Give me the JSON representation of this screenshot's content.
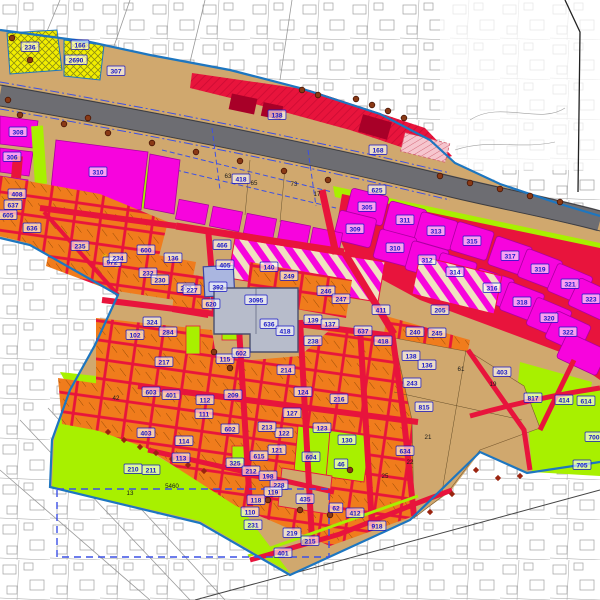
{
  "map": {
    "type": "zoning-development-plan",
    "background": "cadastral-linework"
  },
  "palette": {
    "white": "#ffffff",
    "cadastral": "#8f8f8f",
    "tan": "#d0a86e",
    "tanEdge": "#9a7640",
    "highway": "#6d6d72",
    "highwayEdge": "#3c3c40",
    "red": "#e8143c",
    "redDark": "#a80028",
    "magenta": "#f704dd",
    "magentaEdge": "#aa00a0",
    "orange": "#f07c1c",
    "chartreuse": "#a8f000",
    "chartreuseEdge": "#5a9000",
    "yellow": "#f2ee00",
    "yellowHatch": "#8e8e12",
    "cream": "#f0e2c0",
    "blueBoundary": "#1d76c0",
    "blueDashed": "#3c50e6",
    "labelBlue": "#1616c8",
    "labelBoxBg": "#ffffff",
    "black": "#1a1a1a",
    "buildingGray": "#b7bccb",
    "buildingGrayEdge": "#4a4f6e",
    "buildingBlue": "#aab6e0",
    "tree": "#8a3a16",
    "treeEdge": "#4a1505",
    "shrub": "#9b2410",
    "pinkHatchBg": "#f6c6ce",
    "pinkHatchLine": "#d06070",
    "star": "#e8d800"
  },
  "labels": {
    "blue": [
      [
        "166",
        80,
        45
      ],
      [
        "236",
        30,
        47
      ],
      [
        "2690",
        76,
        60
      ],
      [
        "307",
        116,
        71
      ],
      [
        "138",
        277,
        115
      ],
      [
        "168",
        378,
        150
      ],
      [
        "418",
        241,
        179
      ],
      [
        "625",
        377,
        190
      ],
      [
        "308",
        18,
        132
      ],
      [
        "306",
        12,
        157
      ],
      [
        "310",
        98,
        172
      ],
      [
        "408",
        17,
        194
      ],
      [
        "637",
        13,
        205
      ],
      [
        "605",
        8,
        215
      ],
      [
        "636",
        32,
        228
      ],
      [
        "972",
        112,
        262
      ],
      [
        "235",
        80,
        246
      ],
      [
        "600",
        146,
        250
      ],
      [
        "234",
        118,
        258
      ],
      [
        "136",
        173,
        258
      ],
      [
        "232",
        148,
        273
      ],
      [
        "230",
        160,
        280
      ],
      [
        "207",
        186,
        288
      ],
      [
        "466",
        222,
        245
      ],
      [
        "405",
        225,
        265
      ],
      [
        "140",
        269,
        267
      ],
      [
        "249",
        289,
        276
      ],
      [
        "246",
        326,
        291
      ],
      [
        "247",
        341,
        299
      ],
      [
        "227",
        192,
        290
      ],
      [
        "392",
        218,
        287
      ],
      [
        "620",
        211,
        304
      ],
      [
        "3095",
        256,
        300
      ],
      [
        "636",
        269,
        324
      ],
      [
        "418",
        285,
        331
      ],
      [
        "102",
        135,
        335
      ],
      [
        "324",
        152,
        322
      ],
      [
        "284",
        168,
        332
      ],
      [
        "217",
        164,
        362
      ],
      [
        "115",
        225,
        359
      ],
      [
        "602",
        241,
        353
      ],
      [
        "139",
        313,
        320
      ],
      [
        "137",
        330,
        324
      ],
      [
        "238",
        313,
        341
      ],
      [
        "214",
        286,
        370
      ],
      [
        "411",
        381,
        310
      ],
      [
        "637",
        363,
        331
      ],
      [
        "418",
        383,
        341
      ],
      [
        "305",
        367,
        207
      ],
      [
        "311",
        405,
        220
      ],
      [
        "313",
        436,
        231
      ],
      [
        "315",
        472,
        241
      ],
      [
        "317",
        510,
        256
      ],
      [
        "319",
        540,
        269
      ],
      [
        "321",
        570,
        284
      ],
      [
        "323",
        591,
        299
      ],
      [
        "309",
        355,
        229
      ],
      [
        "310",
        395,
        248
      ],
      [
        "312",
        427,
        260
      ],
      [
        "314",
        455,
        272
      ],
      [
        "316",
        492,
        288
      ],
      [
        "318",
        522,
        302
      ],
      [
        "320",
        549,
        318
      ],
      [
        "322",
        568,
        332
      ],
      [
        "205",
        440,
        310
      ],
      [
        "240",
        415,
        332
      ],
      [
        "245",
        437,
        333
      ],
      [
        "138",
        411,
        356
      ],
      [
        "136",
        427,
        365
      ],
      [
        "403",
        502,
        372
      ],
      [
        "634",
        405,
        451
      ],
      [
        "817",
        533,
        398
      ],
      [
        "414",
        564,
        400
      ],
      [
        "614",
        586,
        401
      ],
      [
        "700",
        594,
        437
      ],
      [
        "705",
        582,
        465
      ],
      [
        "243",
        412,
        383
      ],
      [
        "815",
        424,
        407
      ],
      [
        "209",
        233,
        395
      ],
      [
        "112",
        205,
        400
      ],
      [
        "111",
        204,
        414
      ],
      [
        "124",
        303,
        392
      ],
      [
        "216",
        339,
        399
      ],
      [
        "127",
        292,
        413
      ],
      [
        "123",
        322,
        428
      ],
      [
        "122",
        284,
        433
      ],
      [
        "213",
        267,
        427
      ],
      [
        "602",
        230,
        429
      ],
      [
        "130",
        347,
        440
      ],
      [
        "121",
        277,
        450
      ],
      [
        "604",
        311,
        457
      ],
      [
        "46",
        341,
        464
      ],
      [
        "615",
        259,
        456
      ],
      [
        "325",
        235,
        463
      ],
      [
        "212",
        251,
        471
      ],
      [
        "198",
        268,
        476
      ],
      [
        "228",
        279,
        485
      ],
      [
        "119",
        273,
        492
      ],
      [
        "110",
        250,
        512
      ],
      [
        "118",
        256,
        500
      ],
      [
        "435",
        305,
        499
      ],
      [
        "62",
        336,
        508
      ],
      [
        "412",
        355,
        513
      ],
      [
        "918",
        377,
        526
      ],
      [
        "231",
        253,
        525
      ],
      [
        "219",
        292,
        533
      ],
      [
        "215",
        310,
        541
      ],
      [
        "401",
        283,
        553
      ],
      [
        "603",
        151,
        392
      ],
      [
        "401",
        171,
        395
      ],
      [
        "403",
        146,
        433
      ],
      [
        "114",
        184,
        441
      ],
      [
        "113",
        181,
        458
      ],
      [
        "211",
        151,
        470
      ],
      [
        "210",
        133,
        469
      ]
    ],
    "black": [
      [
        "63",
        228,
        178
      ],
      [
        "65",
        254,
        185
      ],
      [
        "73",
        294,
        186
      ],
      [
        "17",
        317,
        196
      ],
      [
        "61",
        461,
        371
      ],
      [
        "21",
        428,
        439
      ],
      [
        "22",
        410,
        464
      ],
      [
        "19",
        493,
        386
      ],
      [
        "25",
        385,
        478
      ],
      [
        "13",
        130,
        495
      ],
      [
        "42",
        116,
        400
      ],
      [
        "5460",
        172,
        488
      ]
    ]
  },
  "markers": {
    "trees": [
      [
        20,
        115
      ],
      [
        64,
        124
      ],
      [
        108,
        133
      ],
      [
        152,
        143
      ],
      [
        196,
        152
      ],
      [
        240,
        161
      ],
      [
        284,
        171
      ],
      [
        328,
        180
      ],
      [
        440,
        176
      ],
      [
        470,
        183
      ],
      [
        500,
        189
      ],
      [
        530,
        196
      ],
      [
        560,
        202
      ],
      [
        356,
        99
      ],
      [
        372,
        105
      ],
      [
        388,
        111
      ],
      [
        404,
        118
      ],
      [
        302,
        90
      ],
      [
        318,
        95
      ],
      [
        8,
        100
      ],
      [
        30,
        60
      ],
      [
        12,
        38
      ],
      [
        88,
        118
      ],
      [
        214,
        352
      ],
      [
        230,
        368
      ],
      [
        350,
        470
      ],
      [
        310,
        455
      ],
      [
        268,
        500
      ],
      [
        300,
        510
      ],
      [
        305,
        542
      ],
      [
        330,
        515
      ]
    ],
    "shrubs": [
      [
        108,
        432
      ],
      [
        124,
        440
      ],
      [
        140,
        447
      ],
      [
        156,
        453
      ],
      [
        172,
        459
      ],
      [
        188,
        465
      ],
      [
        204,
        471
      ],
      [
        430,
        512
      ],
      [
        452,
        494
      ],
      [
        476,
        470
      ],
      [
        498,
        478
      ],
      [
        520,
        476
      ]
    ],
    "stars": [
      [
        105,
        256
      ],
      [
        117,
        266
      ],
      [
        378,
        150
      ],
      [
        270,
        492
      ]
    ]
  }
}
